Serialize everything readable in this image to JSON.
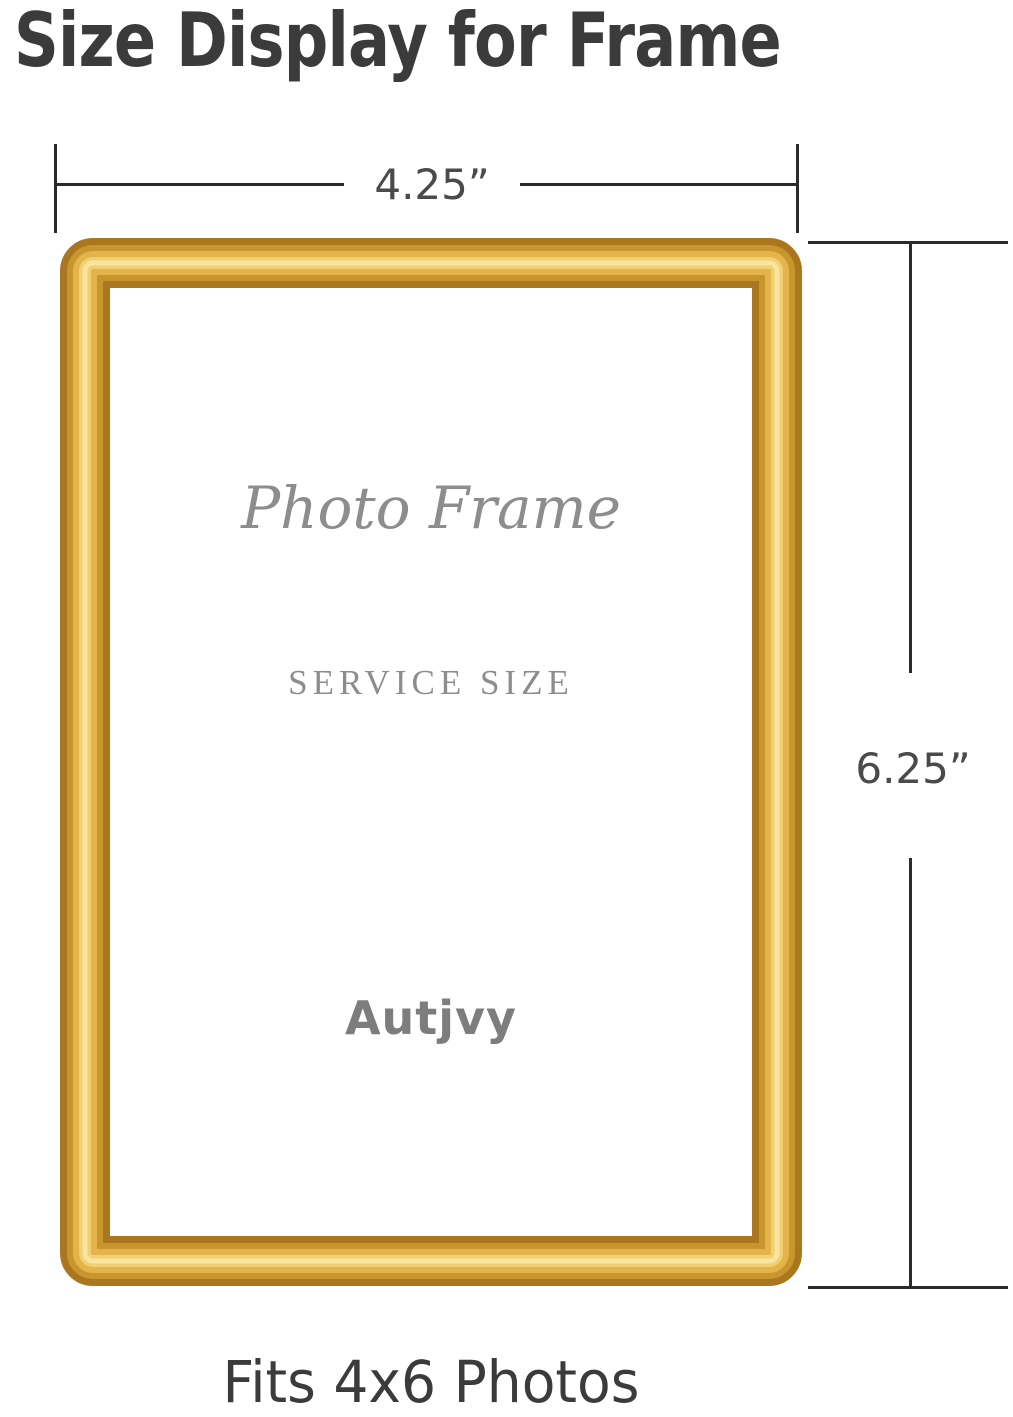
{
  "title": "Size Display for Frame",
  "caption": "Fits 4x6 Photos",
  "dimension_width": {
    "label": "4.25”"
  },
  "dimension_height": {
    "label": "6.25”"
  },
  "frame_text": {
    "script": "Photo Frame",
    "service": "SERVICE SIZE",
    "brand": "Autjvy"
  },
  "colors": {
    "heading": "#3b3b3b",
    "dimension_line": "#2b2b2b",
    "dimension_text": "#4a4a4a",
    "inner_text": "#8d8d8d",
    "brand_text": "#7d7d7d",
    "gold_base": "#aa761e",
    "gold_mid": "#c9952f",
    "gold_bright": "#e2b44a",
    "gold_highlight": "#f1d074",
    "gold_sheen": "#f8e49f"
  }
}
